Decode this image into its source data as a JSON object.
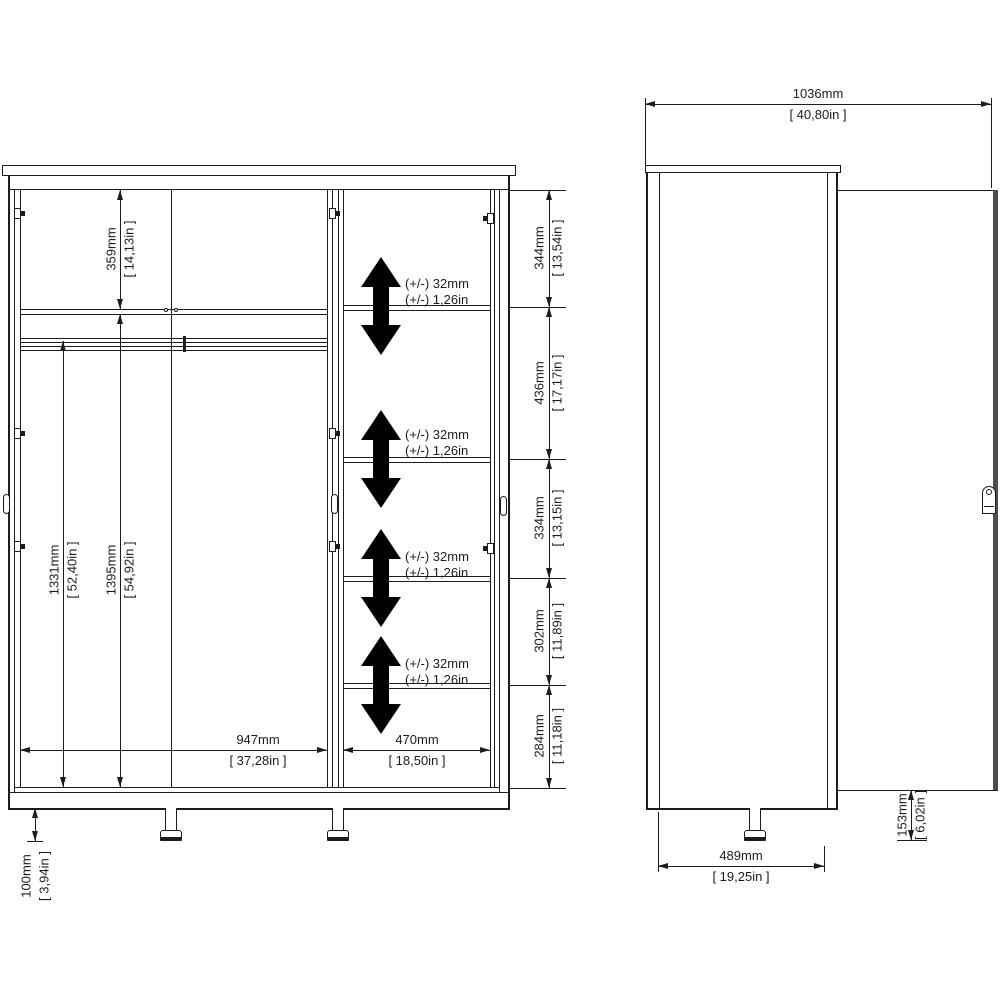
{
  "colors": {
    "background": "#ffffff",
    "line": "#1c1c1c",
    "arrow_fill": "#000000",
    "door_edge_gray": "#4d4d4d"
  },
  "front_view": {
    "dims": {
      "top_section_height": {
        "mm": "359mm",
        "in": "[ 14,13in ]"
      },
      "rail_to_floor": {
        "mm": "1331mm",
        "in": "[ 52,40in ]"
      },
      "shelf_to_floor": {
        "mm": "1395mm",
        "in": "[ 54,92in ]"
      },
      "left_section_width": {
        "mm": "947mm",
        "in": "[ 37,28in ]"
      },
      "right_section_width": {
        "mm": "470mm",
        "in": "[ 18,50in ]"
      },
      "leg_height": {
        "mm": "100mm",
        "in": "[ 3,94in ]"
      }
    },
    "right_column_dims": [
      {
        "mm": "344mm",
        "in": "[ 13,54in ]"
      },
      {
        "mm": "436mm",
        "in": "[ 17,17in ]"
      },
      {
        "mm": "334mm",
        "in": "[ 13,15in ]"
      },
      {
        "mm": "302mm",
        "in": "[ 11,89in ]"
      },
      {
        "mm": "284mm",
        "in": "[ 11,18in ]"
      }
    ],
    "shelf_adjust_notes": [
      {
        "line1": "(+/-) 32mm",
        "line2": "(+/-) 1,26in"
      },
      {
        "line1": "(+/-) 32mm",
        "line2": "(+/-) 1,26in"
      },
      {
        "line1": "(+/-) 32mm",
        "line2": "(+/-) 1,26in"
      },
      {
        "line1": "(+/-) 32mm",
        "line2": "(+/-) 1,26in"
      }
    ]
  },
  "side_view": {
    "dims": {
      "total_depth": {
        "mm": "1036mm",
        "in": "[ 40,80in ]"
      },
      "body_depth": {
        "mm": "489mm",
        "in": "[ 19,25in ]"
      },
      "door_to_floor_gap": {
        "mm": "153mm",
        "in": "[ 6,02in ]"
      }
    }
  }
}
